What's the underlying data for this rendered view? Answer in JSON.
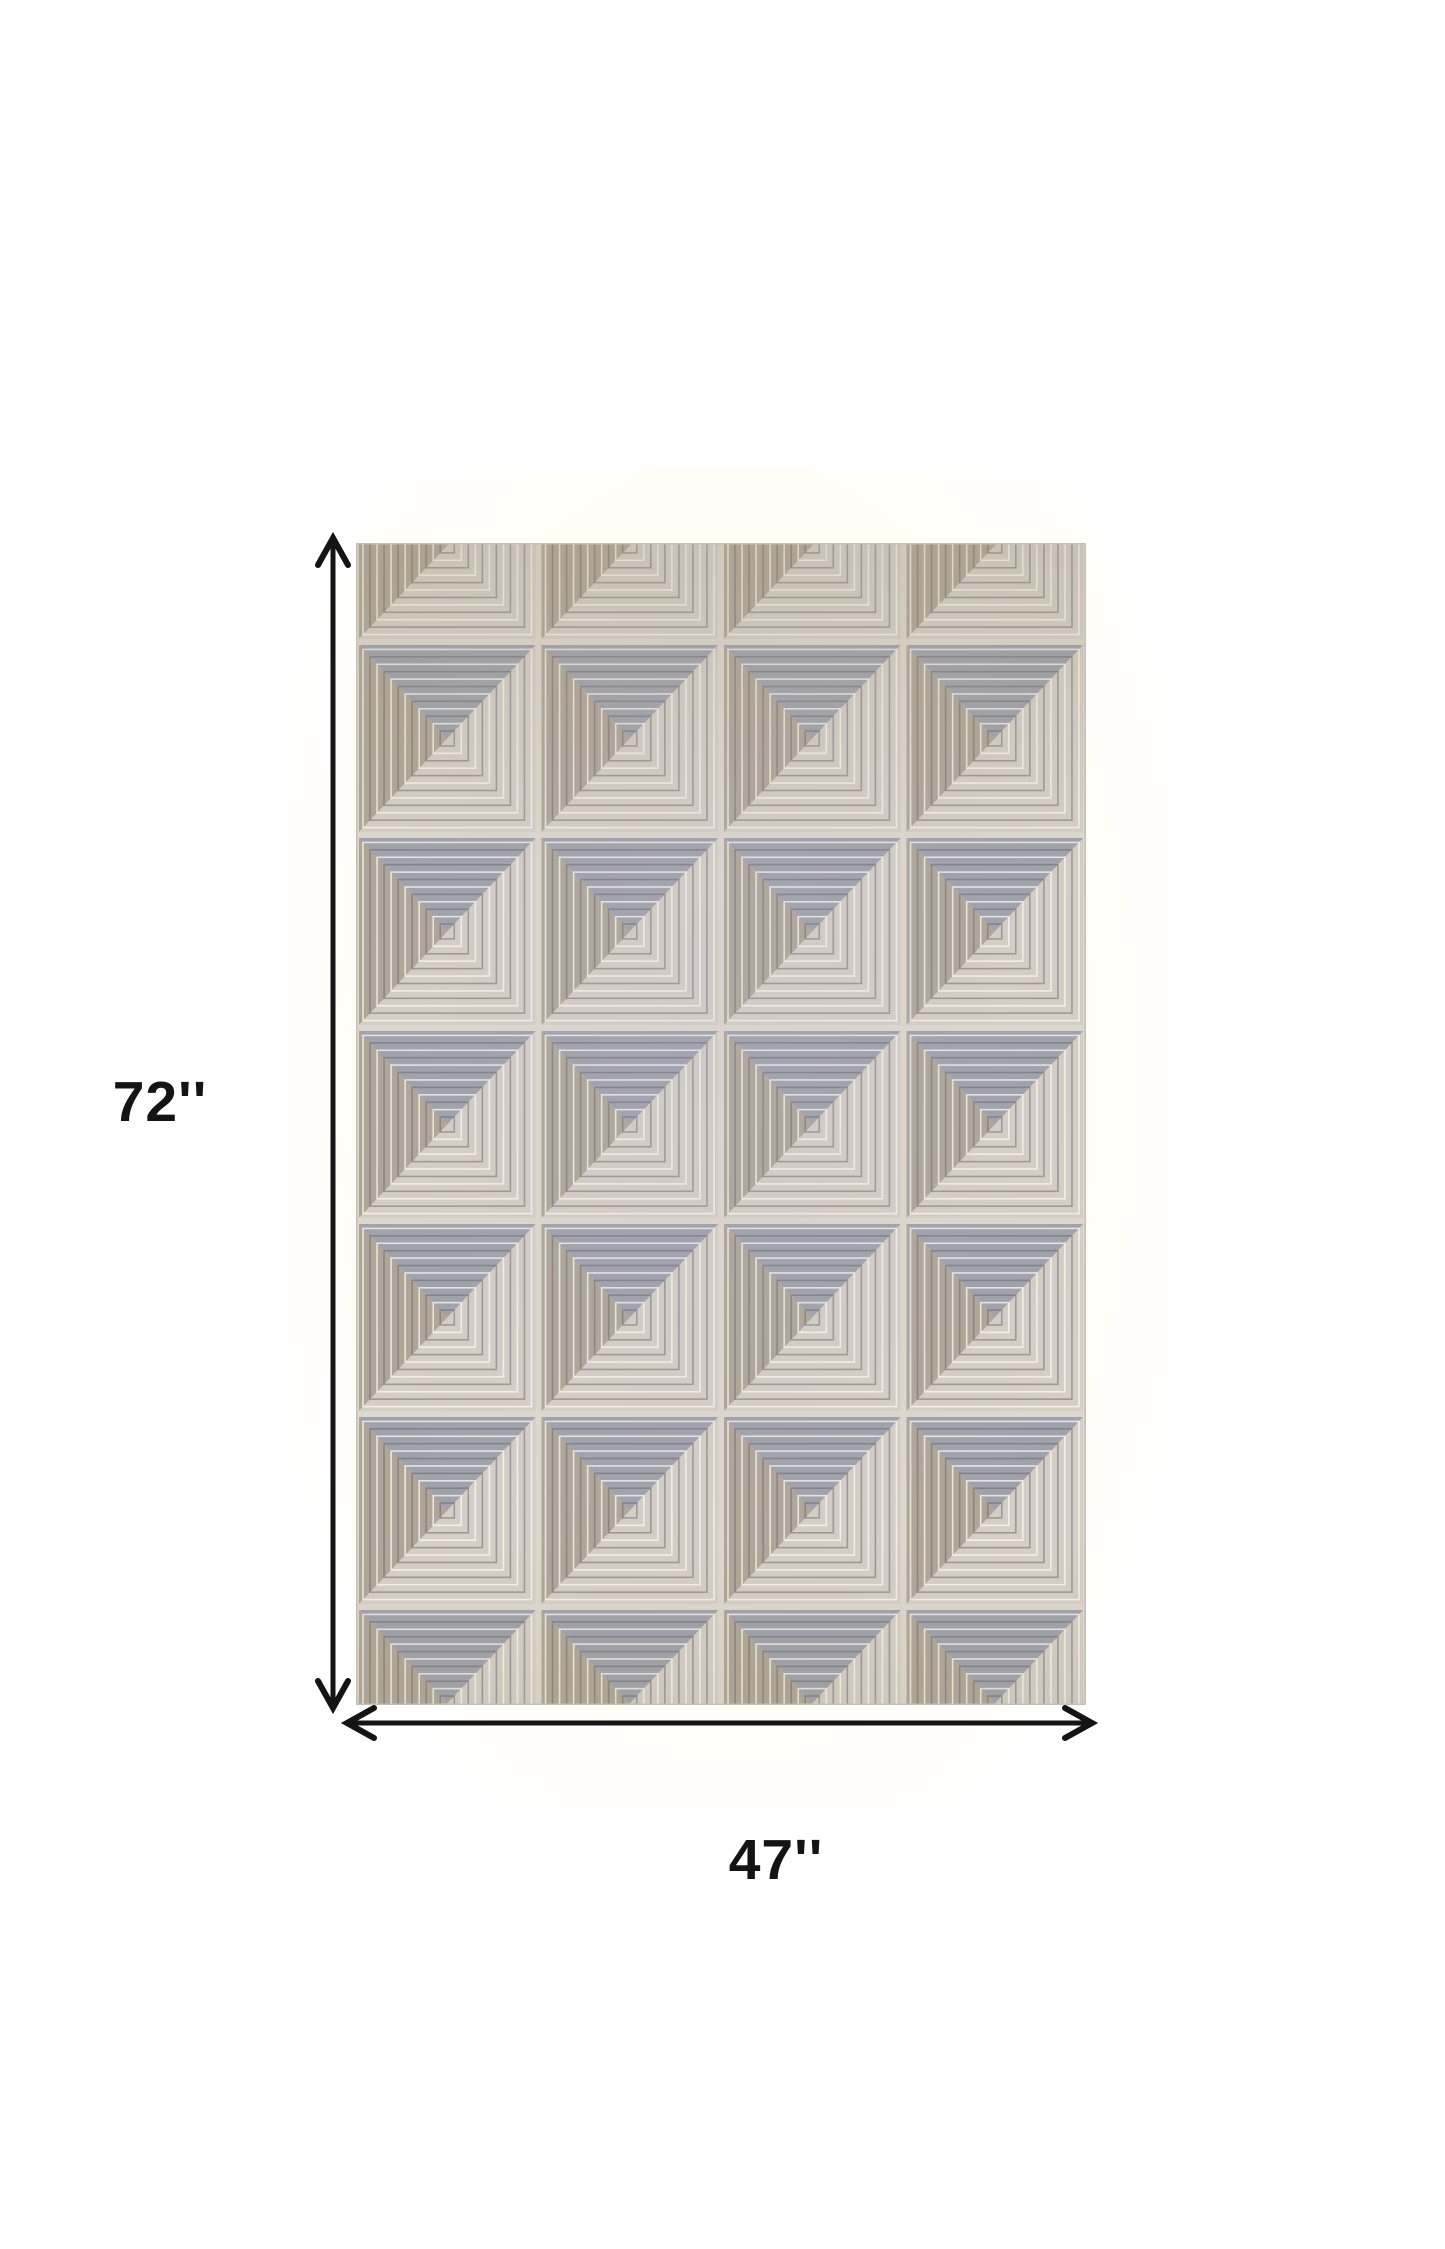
{
  "page": {
    "background_color": "#ffffff",
    "photo_backdrop_color": "#fffdf5"
  },
  "diagram": {
    "height_dimension": {
      "label": "72''"
    },
    "width_dimension": {
      "label": "47''"
    },
    "annotation_color": "#141414",
    "rug": {
      "description": "Beige and gray geometric area rug with embossed 3D pyramid diamond squares in a 4-column grid",
      "grid_columns": 4,
      "colors": {
        "base_bottom": "#d6cfc5",
        "triangle_top": "#9fa1ab",
        "triangle_left": "#afa697",
        "triangle_right": "#d4cec6",
        "ring_light": "#fcfaf4",
        "ring_dark": "#646268",
        "cell_border": "#ded8cd",
        "edge": "#c6c0b4",
        "tint_top": "#a49874",
        "tint_mid": "#bcb6c8"
      }
    }
  }
}
